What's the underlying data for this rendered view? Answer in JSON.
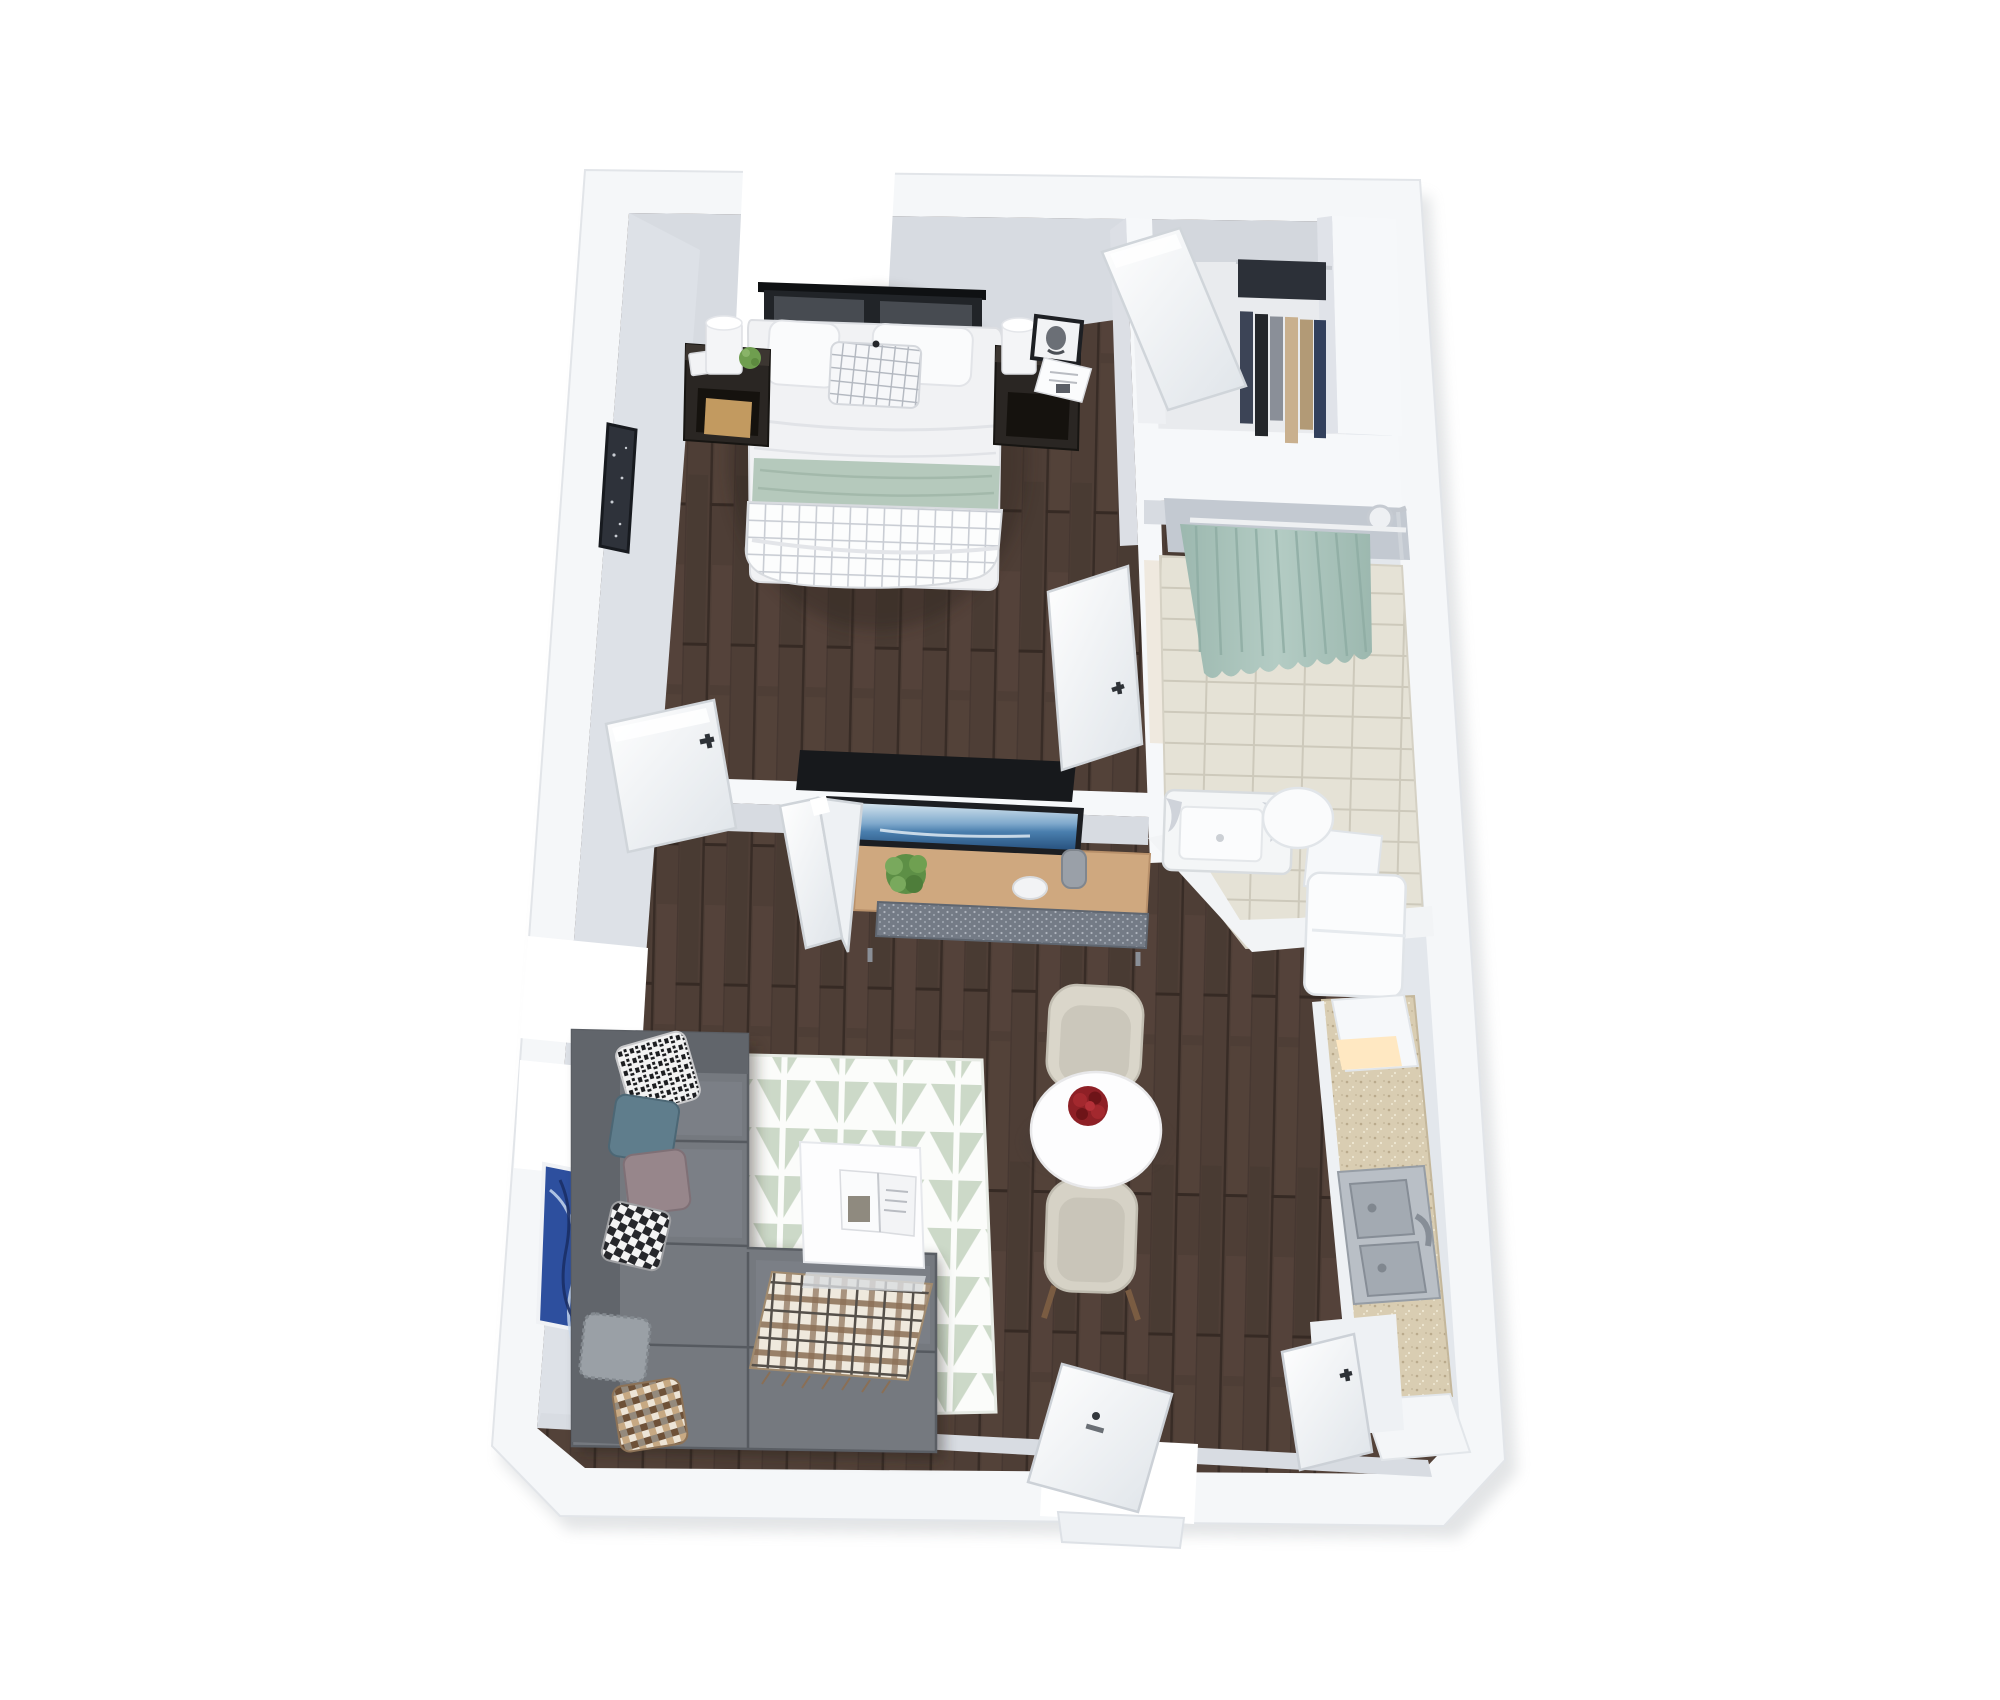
{
  "scene": {
    "title": "3D rendered floor plan of a one-bedroom studio apartment, top-down dollhouse view",
    "view": "isometric top-down 3D render, white background, no visible text",
    "background_color": "#ffffff"
  },
  "palette": {
    "wall_top": "#f5f7f9",
    "wall_face": "#d7dbe1",
    "wall_face_dark": "#c3c9d1",
    "wood_floor": "#4e3e36",
    "wood_plank_line": "#3a2e28",
    "tile_floor": "#e5e2d6",
    "tile_line": "#cdc9bb",
    "shower_curtain": "#a9c3ba",
    "sage_throw": "#b5c9bc",
    "rug_white": "#fbfcfa",
    "rug_sage": "#ccd9c8",
    "sofa_gray": "#75797f",
    "sofa_gray_dark": "#61656b",
    "console_wood": "#cfa87f",
    "granite_counter": "#d9cdb2",
    "rose_red": "#8e2026",
    "art_blue": "#2d4f9e",
    "tv_screen_blue": "#4a7fae",
    "stainless_steel": "#b9bfc6",
    "nightstand_dark": "#2a2623",
    "chair_cream": "#d6d2c6"
  },
  "rooms": {
    "bedroom": {
      "label": "Bedroom",
      "floor": "dark walnut wood planks",
      "furniture": [
        {
          "name": "bed",
          "label": "Queen bed with white duvet, sage green throw band and white grid-pattern foot blanket"
        },
        {
          "name": "headboard",
          "label": "Black metal-frame headboard with two dark gray upholstered panels"
        },
        {
          "name": "pillow-white-left",
          "label": "White pillow"
        },
        {
          "name": "pillow-white-right",
          "label": "White pillow"
        },
        {
          "name": "pillow-grid-accent",
          "label": "White windowpane-grid accent pillow with tassel"
        },
        {
          "name": "nightstand-left",
          "label": "Dark wood nightstand with white cylinder lamp, succulent, note card and wood storage box"
        },
        {
          "name": "nightstand-right",
          "label": "Dark wood nightstand with white cylinder lamp, black framed portrait photo and open magazine"
        },
        {
          "name": "wall-art-dark",
          "label": "Dark abstract wall art on west wall"
        }
      ],
      "windows": [
        "north wall window above bed"
      ]
    },
    "walk_in_closet": {
      "label": "Walk-in closet",
      "floor": "light gray",
      "furniture": [
        {
          "name": "hanging-clothes",
          "label": "Rod of hanging clothes in navy, black, gray, beige and tan"
        },
        {
          "name": "closet-counter",
          "label": "White L-shaped storage counter / half wall"
        }
      ]
    },
    "bathroom": {
      "label": "Bathroom",
      "floor": "beige ceramic tile grid",
      "furniture": [
        {
          "name": "shower-curtain",
          "label": "Sage green shower curtain on rod across shower area"
        },
        {
          "name": "shower-head",
          "label": "Wall-mounted shower head with hand wand"
        },
        {
          "name": "bathtub",
          "label": "White bathtub with marbled towels on the rim"
        },
        {
          "name": "toilet",
          "label": "White toilet with tank"
        }
      ]
    },
    "living_room": {
      "label": "Living room",
      "floor": "dark walnut wood planks",
      "furniture": [
        {
          "name": "sectional-sofa",
          "label": "Gray L-shaped sectional sofa with chaise"
        },
        {
          "name": "throw-pillows",
          "label": "Six throw pillows: black-white patterned, teal, mauve, buffalo check, brown multicheck, textured gray"
        },
        {
          "name": "plaid-throw",
          "label": "Brown and cream plaid throw blanket on chaise"
        },
        {
          "name": "area-rug",
          "label": "White and sage geometric triangle-pattern area rug"
        },
        {
          "name": "coffee-table",
          "label": "White square coffee table with open magazine"
        },
        {
          "name": "wall-art-blue",
          "label": "Blue abstract wall art on west wall"
        }
      ],
      "windows": [
        "two west wall windows"
      ]
    },
    "dining_area": {
      "label": "Dining area",
      "furniture": [
        {
          "name": "dining-table",
          "label": "Round white pedestal table"
        },
        {
          "name": "rose-centerpiece",
          "label": "Red rose bouquet centerpiece"
        },
        {
          "name": "dining-chair-north",
          "label": "Cream upholstered dining chair"
        },
        {
          "name": "dining-chair-south",
          "label": "Cream upholstered dining chair with wood legs"
        }
      ]
    },
    "kitchen": {
      "label": "Kitchen",
      "furniture": [
        {
          "name": "refrigerator",
          "label": "White refrigerator"
        },
        {
          "name": "counter",
          "label": "Speckled granite countertop run along east wall"
        },
        {
          "name": "countertop-appliance",
          "label": "White countertop appliance with warm glowing front"
        },
        {
          "name": "double-sink",
          "label": "Stainless steel double-basin sink with faucet"
        },
        {
          "name": "base-cabinets",
          "label": "White base cabinets and pantry closet"
        }
      ]
    },
    "media_wall": {
      "label": "Media half-wall between bedroom and living room",
      "furniture": [
        {
          "name": "tv",
          "label": "Flat-screen TV showing blue ocean image, facing living room"
        },
        {
          "name": "media-console",
          "label": "Light oak media console with woven gray drawer baskets"
        },
        {
          "name": "console-plant",
          "label": "Green potted plant"
        },
        {
          "name": "console-bowl",
          "label": "White decorative bowl"
        },
        {
          "name": "console-vase",
          "label": "Gray vase"
        }
      ]
    }
  },
  "doors": [
    {
      "name": "bedroom-door",
      "label": "Bedroom door, open into bedroom"
    },
    {
      "name": "bifold-closet-door",
      "label": "Bifold closet door folded open into living room"
    },
    {
      "name": "closet-door",
      "label": "Walk-in closet door, open into closet"
    },
    {
      "name": "bathroom-door",
      "label": "Bathroom door, open toward bedroom walkway"
    },
    {
      "name": "entry-door",
      "label": "Apartment entry door, open inward at south wall with threshold"
    },
    {
      "name": "pantry-door",
      "label": "Pantry / utility closet door, open near kitchen at southeast corner"
    }
  ],
  "windows": [
    {
      "name": "bedroom-north-window",
      "label": "Window opening in north wall above bed"
    },
    {
      "name": "living-west-window-upper",
      "label": "Upper window opening in west wall of living room"
    },
    {
      "name": "living-west-window-lower",
      "label": "Lower window opening in west wall of living room"
    }
  ]
}
